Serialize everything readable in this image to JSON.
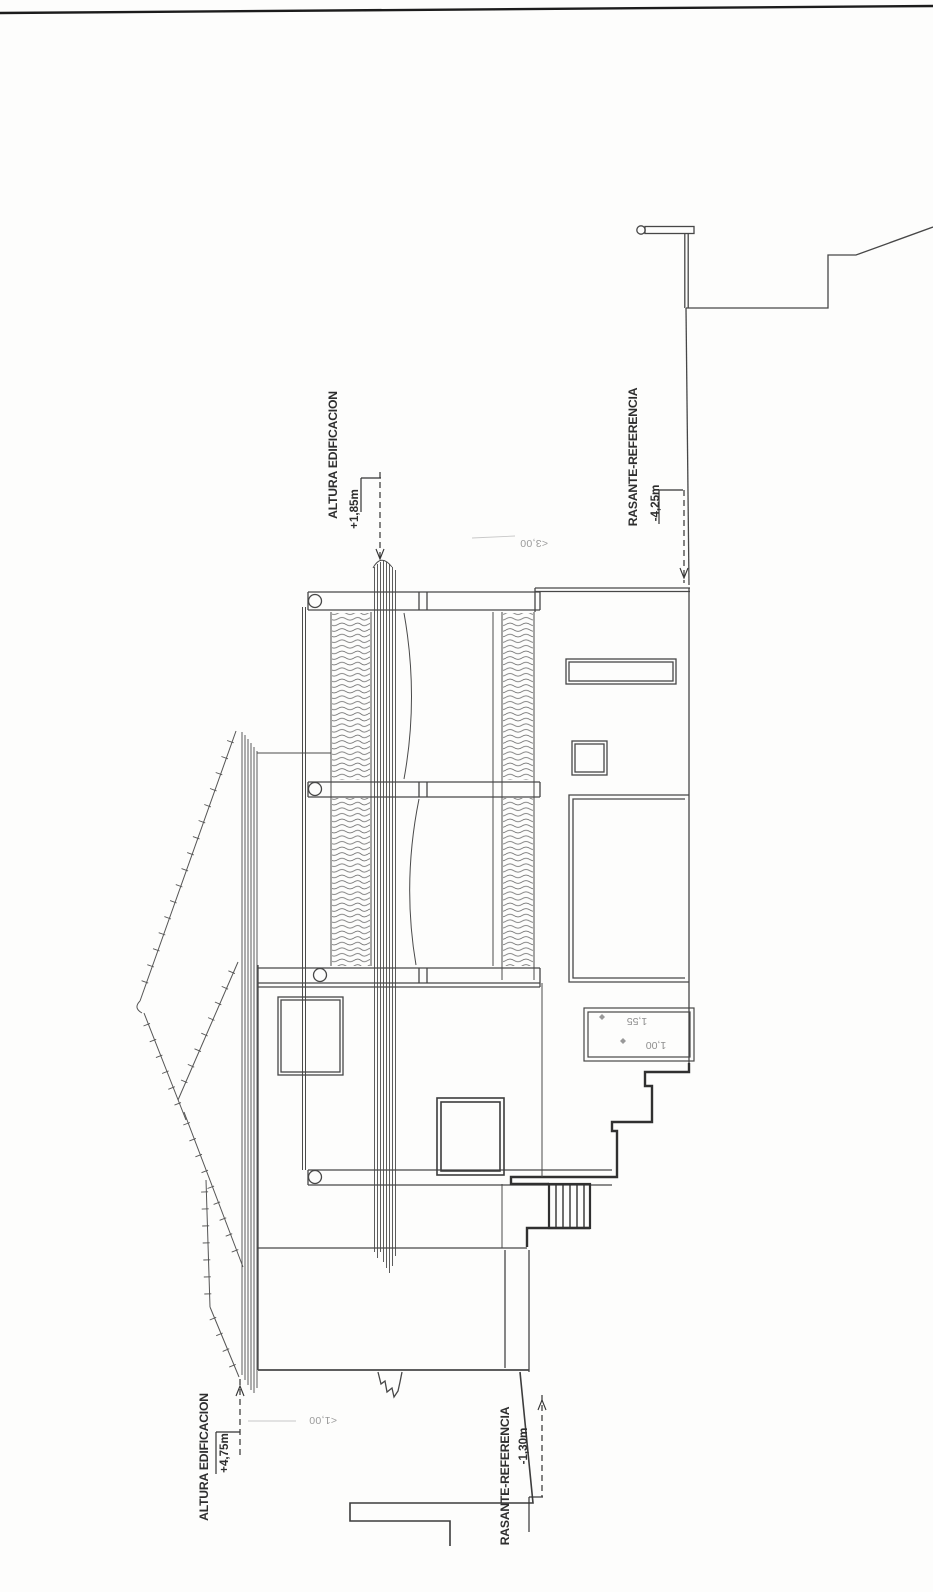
{
  "annotations": {
    "altura_top": {
      "label": "ALTURA EDIFICACION",
      "value": "+1,85m"
    },
    "rasante_top": {
      "label": "RASANTE-REFERENCIA",
      "value": "-4,25m"
    },
    "altura_bottom": {
      "label": "ALTURA EDIFICACION",
      "value": "+4,75m"
    },
    "rasante_bottom": {
      "label": "RASANTE-REFERENCIA",
      "value": "-1,30m"
    }
  },
  "dimensions": {
    "upper_span": "<3,00",
    "pool_a": "1,55",
    "pool_b": "1,00",
    "lower_span": "<1,00"
  },
  "colors": {
    "ink": "#3f3f3f",
    "thick": "#2f2f2f",
    "faint": "#9a9a9a",
    "paper": "#fdfdfc"
  }
}
